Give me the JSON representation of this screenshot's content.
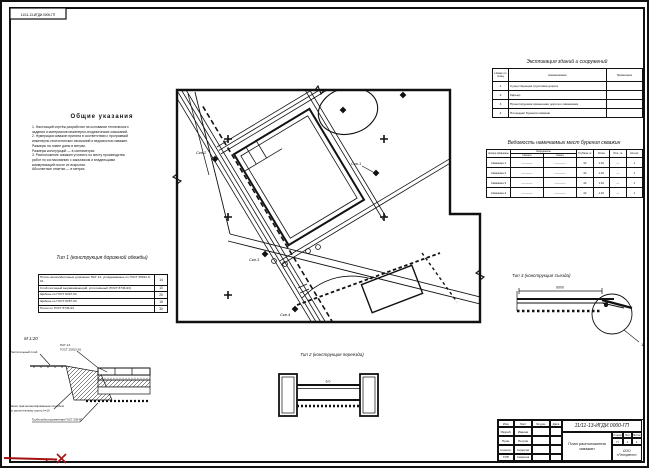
{
  "page": {
    "stamp_code": "11/11-13-ИГДИ.0000-ГП"
  },
  "notes": {
    "title": "Общие указания",
    "lines": [
      "1. Настоящий чертёж разработан на основании технического",
      "задания и материалов инженерно-геодезических изысканий.",
      "2. Нумерация скважин принята в соответствии с программой",
      "инженерно-геологических изысканий и ведомостью скважин.",
      "Размеры на плане даны в метрах.",
      "Размеры конструкций — в сантиметрах.",
      "3. Расположение скважин уточнить по месту производства",
      "работ по согласованию с заказчиком и владельцами",
      "коммуникаций после их вскрытия.",
      "Абсолютные отметки — в метрах."
    ]
  },
  "plan": {
    "well_labels": [
      "Скв.1",
      "Скв.2",
      "Скв.3",
      "Скв.4"
    ]
  },
  "explication": {
    "title": "Экспликация зданий и сооружений",
    "col_no": "Номер по плану",
    "col_name": "Наименование",
    "col_note": "Примечание",
    "rows": [
      {
        "no": "1",
        "name": "Существующая грунтовая дорога",
        "note": ""
      },
      {
        "no": "2",
        "name": "Карьер",
        "note": ""
      },
      {
        "no": "3",
        "name": "Проектируемая временная дорога к скважинам",
        "note": ""
      },
      {
        "no": "4",
        "name": "Площадки бурения скважин",
        "note": ""
      }
    ]
  },
  "wells_table": {
    "title": "Ведомость намечаемых мест бурения скважин",
    "col_no": "Номер скважины",
    "col_coords": "Координаты",
    "col_x": "Начало",
    "col_y": "Конец",
    "col_depth": "Глубина, м",
    "col_slope": "Уклон",
    "col_elev": "Отм., м",
    "col_qty": "Кол-во",
    "rows": [
      {
        "name": "Скважина 1",
        "x": "————",
        "y": "————",
        "depth": "10",
        "slope": "1:10",
        "elev": "—",
        "qty": "1"
      },
      {
        "name": "Скважина 2",
        "x": "————",
        "y": "————",
        "depth": "10",
        "slope": "1:10",
        "elev": "—",
        "qty": "1"
      },
      {
        "name": "Скважина 3",
        "x": "————",
        "y": "————",
        "depth": "10",
        "slope": "1:10",
        "elev": "—",
        "qty": "1"
      },
      {
        "name": "Скважина 4",
        "x": "————",
        "y": "————",
        "depth": "10",
        "slope": "1:10",
        "elev": "—",
        "qty": "1"
      }
    ]
  },
  "type1": {
    "title": "Тип 1 (конструкция дорожной одежды)",
    "layers": [
      {
        "text": "Плиты железобетонные дорожные ПАГ-14, укладываемые по ГОСТ 25912.0-91",
        "h": "14"
      },
      {
        "text": "Слой песчаный выравнивающий, уплотнённый (ГОСТ 8736-93)",
        "h": "10"
      },
      {
        "text": "Щебень по ГОСТ 8267-93",
        "h": "20"
      },
      {
        "text": "Щебень по ГОСТ 8267-93",
        "h": "15"
      },
      {
        "text": "Песок по ГОСТ 8736-93",
        "h": "30"
      }
    ]
  },
  "section": {
    "scale": "М 1:20",
    "callout_plate1": "ПАГ-14",
    "callout_plate2": "ГОСТ 25912-91",
    "callout_soil": "Растительный слой",
    "callout_grass1": "Засев трав механизированным способом",
    "callout_grass2": "по растительному грунту h=10",
    "callout_pipe": "Труба асбестоцементная ГОСТ 539-80"
  },
  "type2": {
    "title": "Тип 2 (конструкция переезда)",
    "dim": "6,0"
  },
  "type3": {
    "title": "Тип 3 (конструкция съезда)",
    "dim": "6000",
    "detail_ref": "1"
  },
  "titleblock": {
    "doc": "11/11-13-ИГДИ.0000-ГП",
    "name1": "План расположения",
    "name2": "скважин",
    "h_stage": "Стадия",
    "h_sheet": "Лист",
    "h_sheets": "Листов",
    "stage": "П",
    "sheet": "1",
    "sheets": "1",
    "org": "ООО «Геотрест»",
    "hdr": [
      "Изм.",
      "Лист",
      "№ док.",
      "Дата"
    ],
    "rows": [
      [
        "Разраб.",
        "Иванов"
      ],
      [
        "Пров.",
        "Петров"
      ],
      [
        "Н.контр.",
        "Сидоров"
      ],
      [
        "ГИП",
        "Смирнов"
      ]
    ]
  }
}
